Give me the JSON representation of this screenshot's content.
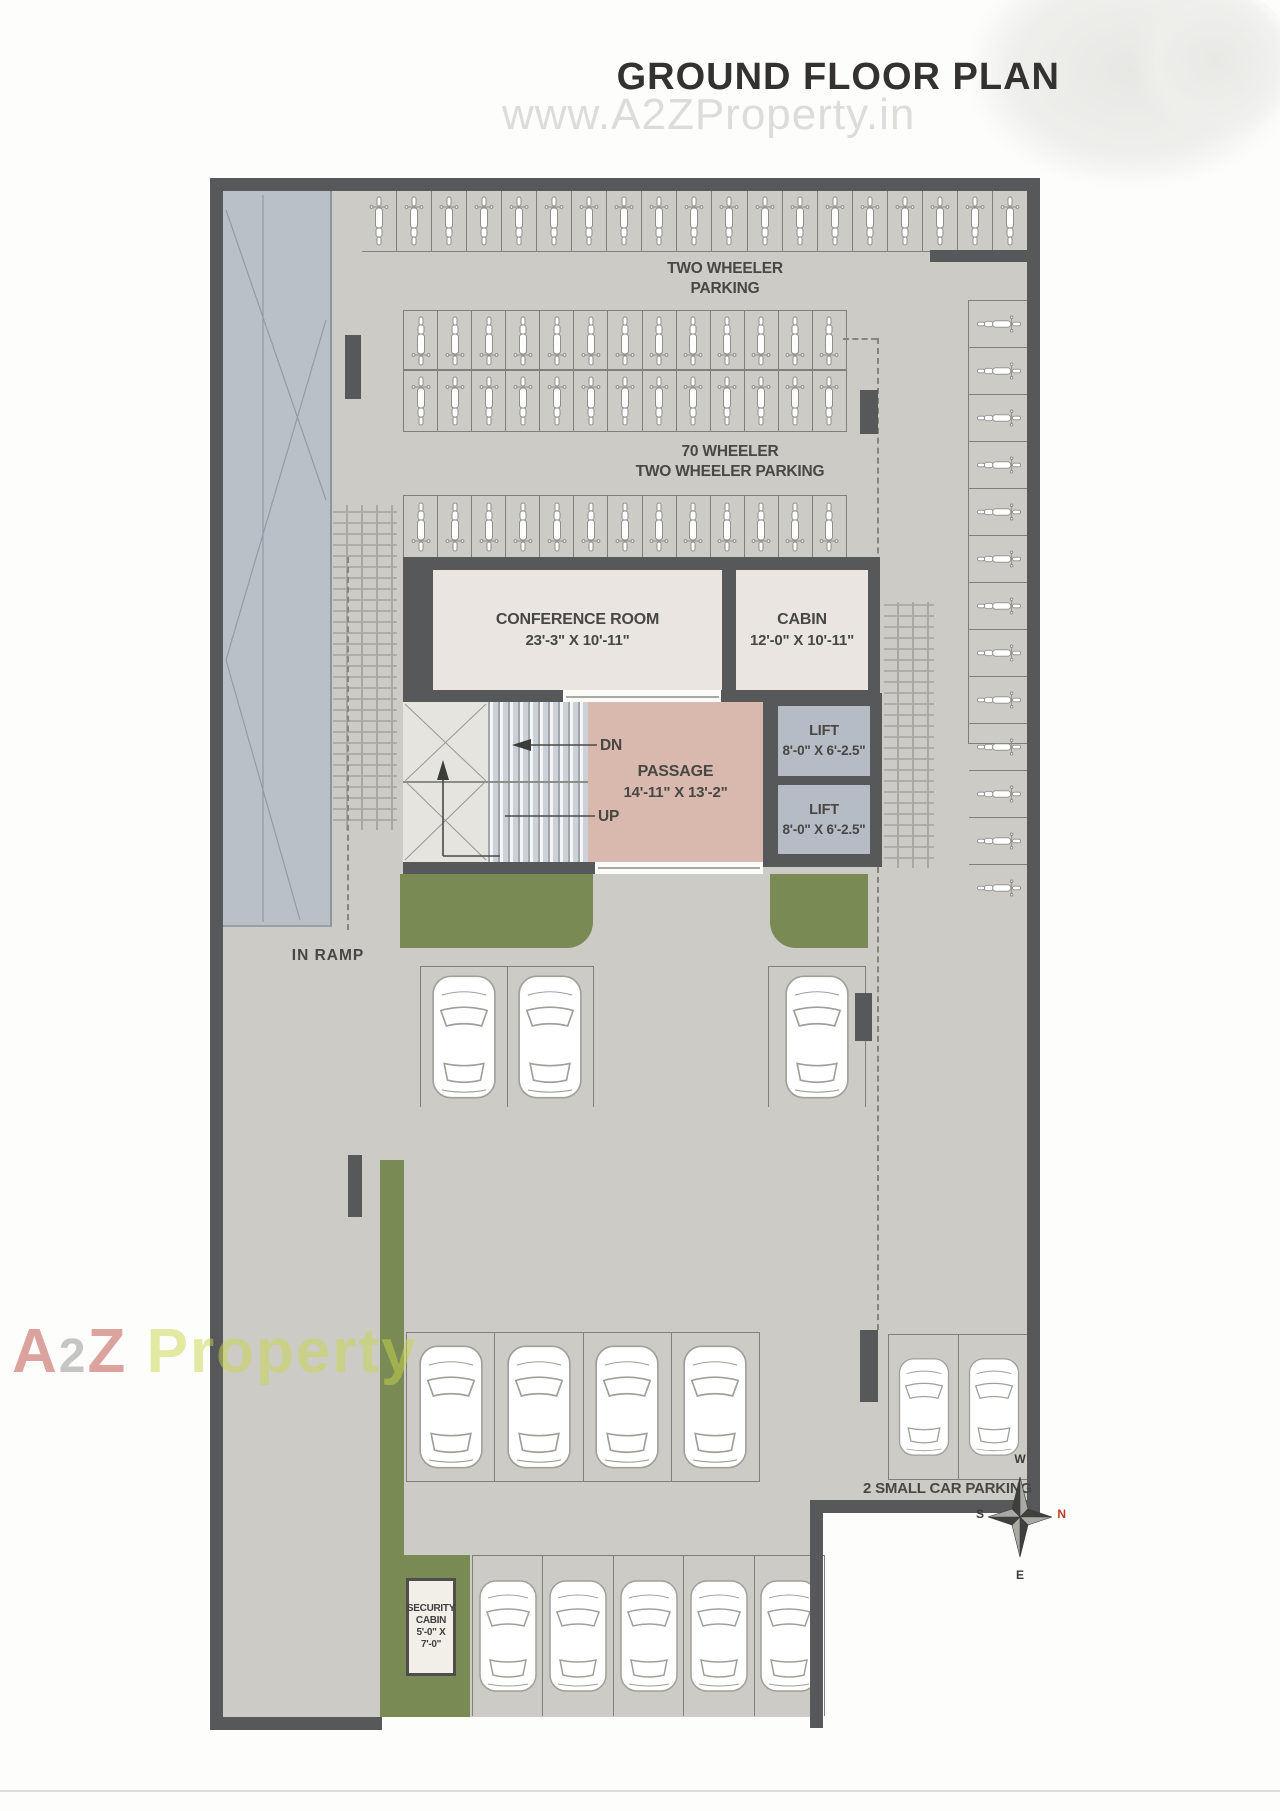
{
  "title": "GROUND FLOOR PLAN",
  "watermark_top": "www.A2ZProperty.in",
  "watermark_bottom": {
    "part_a": "A",
    "part_2": "2",
    "part_z": "Z",
    "part_rest": " Property"
  },
  "labels": {
    "two_wheeler_l1": "TWO WHEELER",
    "two_wheeler_l2": "PARKING",
    "seventy_l1": "70 WHEELER",
    "seventy_l2": "TWO WHEELER PARKING",
    "conference_name": "CONFERENCE ROOM",
    "conference_dim": "23'-3\" X 10'-11\"",
    "cabin_name": "CABIN",
    "cabin_dim": "12'-0\" X 10'-11\"",
    "lift_name": "LIFT",
    "lift_dim": "8'-0\" X 6'-2.5\"",
    "passage_name": "PASSAGE",
    "passage_dim": "14'-11\" X 13'-2\"",
    "stair_dn": "DN",
    "stair_up": "UP",
    "in_ramp": "IN RAMP",
    "small_car_parking": "2 SMALL CAR PARKING",
    "security_l1": "SECURITY",
    "security_l2": "CABIN",
    "security_dim": "5'-0\" X 7'-0\""
  },
  "compass": {
    "w": "W",
    "n": "N",
    "e": "E",
    "s": "S"
  },
  "parking": {
    "top_row_bikes": 19,
    "mid_row_a_bikes": 13,
    "mid_row_b_bikes": 13,
    "mid_row_c_bikes": 13,
    "right_col_bikes": 13,
    "row1_left_cars": 2,
    "row1_right_cars": 1,
    "row2_large_cars": 4,
    "row2_small_cars": 2,
    "bottom_row_cars": 5
  },
  "colors": {
    "wall": "#57585a",
    "floor": "#cccbc6",
    "ramp": "#b9c0c8",
    "room_fill": "#eae5e0",
    "passage_fill": "#d9b9ad",
    "lift_fill": "#b6bcc5",
    "green": "#7a8a54",
    "compass_north_red": "#c0392b",
    "watermark_red": "#bd4a40",
    "watermark_green": "#c9d64b"
  }
}
